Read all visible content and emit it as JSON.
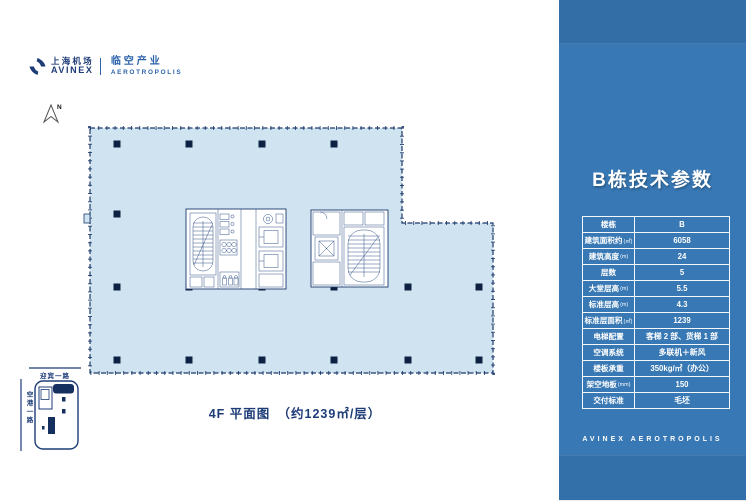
{
  "brand": {
    "icon": "avinex-diamond-icon",
    "cn_name": "上海机场",
    "en_name": "AVINEX",
    "division_cn": "临空产业",
    "division_en": "AEROTROPOLIS"
  },
  "plan": {
    "north_label": "N",
    "caption": "4F 平面图　（约1239㎡/层）"
  },
  "site_map": {
    "road_top": "迎宾一路",
    "road_left": "空港一路"
  },
  "panel": {
    "title": "B栋技术参数",
    "footer": "AVINEX AEROTROPOLIS",
    "colors": {
      "panel_blue": "#3878b4",
      "plan_fill": "#cfe3f1",
      "line_navy": "#1c3a6b",
      "column_dark": "#0d2242"
    },
    "table": {
      "rows": [
        {
          "label": "楼栋",
          "unit": "",
          "value": "B"
        },
        {
          "label": "建筑面积约",
          "unit": "(㎡)",
          "value": "6058"
        },
        {
          "label": "建筑高度",
          "unit": "(m)",
          "value": "24"
        },
        {
          "label": "层数",
          "unit": "",
          "value": "5"
        },
        {
          "label": "大堂层高",
          "unit": "(m)",
          "value": "5.5"
        },
        {
          "label": "标准层高",
          "unit": "(m)",
          "value": "4.3"
        },
        {
          "label": "标准层面积",
          "unit": "(㎡)",
          "value": "1239"
        },
        {
          "label": "电梯配置",
          "unit": "",
          "value": "客梯 2 部、货梯 1 部"
        },
        {
          "label": "空调系统",
          "unit": "",
          "value": "多联机＋新风"
        },
        {
          "label": "楼板承重",
          "unit": "",
          "value": "350kg/㎡（办公）"
        },
        {
          "label": "架空地板",
          "unit": "(mm)",
          "value": "150"
        },
        {
          "label": "交付标准",
          "unit": "",
          "value": "毛坯"
        }
      ]
    }
  }
}
